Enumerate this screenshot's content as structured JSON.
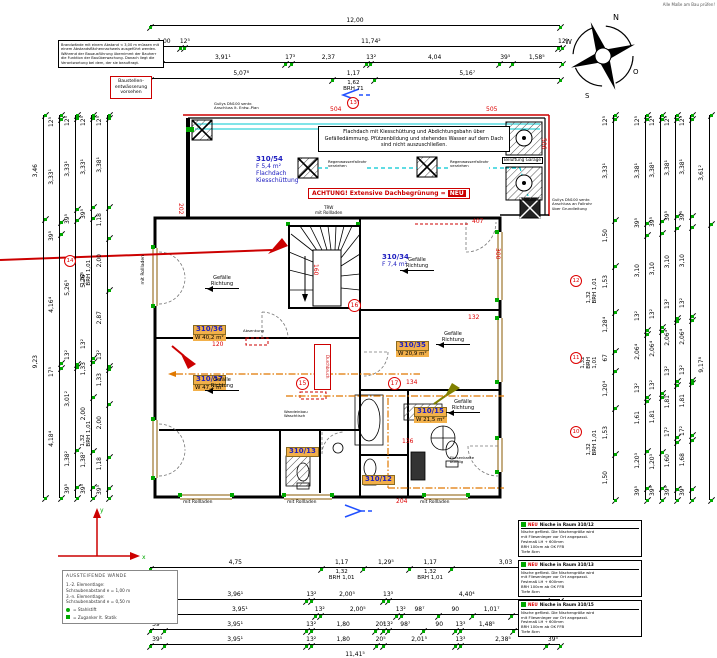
{
  "colors": {
    "tick_green": "#00a800",
    "position_red": "#dd0000",
    "room_highlight": "#f2b04a",
    "pipe_cyan": "#00c8d2",
    "label_blue": "#2020c0",
    "install_orange": "#e07800",
    "window_brown": "#8a5a00"
  },
  "corner_note": "Alle Maße am Bau prüfen!",
  "compass": {
    "n": "N",
    "o": "O",
    "s": "S",
    "w": "W"
  },
  "axes": {
    "x": "x",
    "y": "y"
  },
  "notes": {
    "general": "Brandwände mit einem Abstand < 3,00 m müssen mit einem Abstandsflächennachweis ausgeführt werden. Während der Bauausführung übernimmt der Bauherr die Funktion der Bauüberwachung. Danach liegt die Verantwortung bei dem, der sie beauftragt.",
    "drainage": "Baustellen- entwässerung vorsehen"
  },
  "roof": {
    "note": "Flachdach mit Kiesschüttung und Abdichtungsbahn über Gefälledämmung. Pfützenbildung und stehendes Wasser auf dem Dach sind nicht auszuschließen.",
    "warning_pre": "ACHTUNG! Extensive Dachbegrünung =",
    "warning_tag": "NEU",
    "trw": "TRW\nmit Rollladen",
    "garage_vent": "Belüftung Garage",
    "drain_left": "Gullys DN100 senkr.\nAnschluss lt. Entw.-Plan",
    "drain_mid1": "Regenwasserfallrohr\nverziehen",
    "drain_mid2": "Regenwasserfallrohr\nverziehen",
    "drain_right": "Gullys DN100 senkr.\nAnschluss an Fallrohr\nüber Grundleitung"
  },
  "plan": {
    "gefaelle_text": "Gefälle\nRichtung",
    "rooms": [
      {
        "id": "310/36",
        "area": "W 40,2 m²",
        "x": 193,
        "y": 316
      },
      {
        "id": "310/37",
        "area": "W 47,2 m²",
        "x": 193,
        "y": 366
      },
      {
        "id": "310/35",
        "area": "W 20,9 m²",
        "x": 396,
        "y": 332
      },
      {
        "id": "310/15",
        "area": "W 21,5 m²",
        "x": 414,
        "y": 398
      },
      {
        "id": "310/13",
        "area": "",
        "x": 286,
        "y": 438
      },
      {
        "id": "310/12",
        "area": "",
        "x": 362,
        "y": 466
      }
    ],
    "blue_labels": [
      {
        "id": "310/54",
        "lines": "F 5,4 m²\nFlachdach\nKiesschüttung",
        "x": 256,
        "y": 148
      },
      {
        "id": "310/34",
        "lines": "F 7,4 m²",
        "x": 382,
        "y": 246
      }
    ],
    "gefaelle": [
      {
        "x": 205,
        "y": 276
      },
      {
        "x": 205,
        "y": 378
      },
      {
        "x": 436,
        "y": 332
      },
      {
        "x": 400,
        "y": 258
      },
      {
        "x": 446,
        "y": 400
      }
    ],
    "red_tags": [
      {
        "t": "504",
        "x": 330,
        "y": 107
      },
      {
        "t": "505",
        "x": 486,
        "y": 107
      },
      {
        "t": "506",
        "x": 540,
        "y": 138,
        "vert": true
      },
      {
        "t": "202",
        "x": 177,
        "y": 203,
        "vert": true
      },
      {
        "t": "160",
        "x": 312,
        "y": 264,
        "vert": true
      },
      {
        "t": "120",
        "x": 212,
        "y": 342
      },
      {
        "t": "132",
        "x": 468,
        "y": 315
      },
      {
        "t": "134",
        "x": 406,
        "y": 380
      },
      {
        "t": "136",
        "x": 402,
        "y": 439
      },
      {
        "t": "300",
        "x": 494,
        "y": 248,
        "vert": true
      },
      {
        "t": "407",
        "x": 472,
        "y": 219
      },
      {
        "t": "204",
        "x": 396,
        "y": 499
      }
    ],
    "circles": [
      {
        "n": "16",
        "x": 348,
        "y": 299
      },
      {
        "n": "15",
        "x": 296,
        "y": 377
      },
      {
        "n": "17",
        "x": 388,
        "y": 377
      }
    ],
    "window_labels": [
      {
        "t": "mit Rollladen",
        "x": 142,
        "y": 255,
        "vert": true
      },
      {
        "t": "mit Rollladen",
        "x": 183,
        "y": 501
      },
      {
        "t": "mit Rollladen",
        "x": 287,
        "y": 501
      },
      {
        "t": "mit Rollladen",
        "x": 420,
        "y": 501
      }
    ],
    "micro": [
      {
        "t": "Absenkung",
        "x": 243,
        "y": 329
      },
      {
        "t": "Wandeinbau\nWaschtisch",
        "x": 284,
        "y": 410
      },
      {
        "t": "Fliesenkante\nbündig",
        "x": 450,
        "y": 456
      }
    ],
    "durchbruch": "Durchbruch"
  },
  "legend_left": {
    "title": "AUSSTEIFENDE WÄNDE",
    "lines": [
      "1.-2. Elementlage:",
      "Schraubenabstand e = 1,00 m",
      "3.-n. Elementlage:",
      "Schraubenabstand e = 0,50 m"
    ],
    "items": [
      {
        "t": "= Stahlstift"
      },
      {
        "t": "= Zuganker lt. Statik"
      }
    ]
  },
  "legend_right": {
    "boxes": [
      {
        "tag": "NEU",
        "title": "Nische in Raum 310/12",
        "lines": [
          "Nische gefliest. Die Nischengröße wird",
          "mit Fliesenleger vor Ort angepasst.",
          "Festmaß LH + 600mm",
          "BRH 100cm ab OK FFB",
          "Tiefe 8cm"
        ]
      },
      {
        "tag": "NEU",
        "title": "Nische in Raum 310/13",
        "lines": [
          "Nische gefliest. Die Nischengröße wird",
          "mit Fliesenleger vor Ort angepasst.",
          "Festmaß LH + 600mm",
          "BRH 100cm ab OK FFB",
          "Tiefe 8cm"
        ]
      },
      {
        "tag": "NEU",
        "title": "Nische in Raum 310/15",
        "lines": [
          "Nische gefliest. Die Nischengröße wird",
          "mit Fliesenleger vor Ort angepasst.",
          "Festmaß LH + 600mm",
          "BRH 100cm ab OK FFB",
          "Tiefe 8cm"
        ]
      }
    ]
  },
  "dims": [
    {
      "id": "t1",
      "dir": "h",
      "x": 150,
      "y": 12,
      "len": 410,
      "segs": [
        {
          "t": "12,00",
          "v": 12
        }
      ]
    },
    {
      "id": "t2",
      "dir": "h",
      "x": 148,
      "y": 33,
      "len": 414,
      "segs": [
        {
          "t": "1,00",
          "v": 1
        },
        {
          "t": "12⁵",
          "v": 0.125
        },
        {
          "t": "11,74²",
          "v": 11.742
        },
        {
          "t": "12⁵",
          "v": 0.125
        }
      ]
    },
    {
      "id": "t3",
      "dir": "h",
      "x": 148,
      "y": 49,
      "len": 414,
      "segs": [
        {
          "t": "39⁵",
          "v": 0.395
        },
        {
          "t": "3,91¹",
          "v": 3.911
        },
        {
          "t": "17³",
          "v": 0.173
        },
        {
          "t": "2,37",
          "v": 2.37
        },
        {
          "t": "13²",
          "v": 0.132
        },
        {
          "t": "4,04",
          "v": 4.04
        },
        {
          "t": "39⁵",
          "v": 0.395
        },
        {
          "t": "1,58⁵",
          "v": 1.585
        }
      ]
    },
    {
      "id": "t4",
      "dir": "h",
      "x": 150,
      "y": 65,
      "len": 410,
      "segs": [
        {
          "t": "5,07⁸",
          "v": 5.078
        },
        {
          "t": "1,17",
          "v": 1.17,
          "sub": "1,62\nBRH 71",
          "circ": "13"
        },
        {
          "t": "5,16⁷",
          "v": 5.167
        }
      ]
    },
    {
      "id": "b1",
      "dir": "h",
      "x": 150,
      "y": 554,
      "len": 410,
      "segs": [
        {
          "t": "4,75",
          "v": 4.75
        },
        {
          "t": "1,17",
          "v": 1.17,
          "sub": "1,32\nBRH 1,01"
        },
        {
          "t": "1,29⁵",
          "v": 1.295
        },
        {
          "t": "1,17",
          "v": 1.17,
          "sub": "1,32\nBRH 1,01"
        },
        {
          "t": "3,03",
          "v": 3.03
        }
      ]
    },
    {
      "id": "b2",
      "dir": "h",
      "x": 150,
      "y": 586,
      "len": 410,
      "segs": [
        {
          "t": "39⁵",
          "v": 0.395
        },
        {
          "t": "3,96¹",
          "v": 3.961
        },
        {
          "t": "13²",
          "v": 0.132
        },
        {
          "t": "2,00⁵",
          "v": 2.005
        },
        {
          "t": "13³",
          "v": 0.133
        },
        {
          "t": "4,40⁴",
          "v": 4.404
        },
        {
          "t": "39⁵",
          "v": 0.395
        }
      ]
    },
    {
      "id": "b3",
      "dir": "h",
      "x": 150,
      "y": 601,
      "len": 410,
      "segs": [
        {
          "t": "39⁵",
          "v": 0.395
        },
        {
          "t": "3,95¹",
          "v": 3.951
        },
        {
          "t": "13²",
          "v": 0.132
        },
        {
          "t": "2,00⁵",
          "v": 2.005
        },
        {
          "t": "13²",
          "v": 0.132
        },
        {
          "t": "98⁷",
          "v": 0.987
        },
        {
          "t": "90",
          "v": 0.9
        },
        {
          "t": "1,01⁷",
          "v": 1.017
        },
        {
          "t": "90",
          "v": 0.9
        },
        {
          "t": "39⁵",
          "v": 0.395
        }
      ]
    },
    {
      "id": "b4",
      "dir": "h",
      "x": 150,
      "y": 616,
      "len": 410,
      "segs": [
        {
          "t": "39⁵",
          "v": 0.395
        },
        {
          "t": "3,95¹",
          "v": 3.951
        },
        {
          "t": "13²",
          "v": 0.132
        },
        {
          "t": "1,80",
          "v": 1.8
        },
        {
          "t": "20⁵",
          "v": 0.205
        },
        {
          "t": "13²",
          "v": 0.132
        },
        {
          "t": "98⁷",
          "v": 0.987
        },
        {
          "t": "90",
          "v": 0.9
        },
        {
          "t": "13³",
          "v": 0.133
        },
        {
          "t": "1,48⁵",
          "v": 1.485
        },
        {
          "t": "90",
          "v": 0.9
        },
        {
          "t": "39⁵",
          "v": 0.395
        }
      ]
    },
    {
      "id": "b5",
      "dir": "h",
      "x": 150,
      "y": 631,
      "len": 410,
      "segs": [
        {
          "t": "39⁵",
          "v": 0.395
        },
        {
          "t": "3,95¹",
          "v": 3.951
        },
        {
          "t": "13²",
          "v": 0.132
        },
        {
          "t": "1,80",
          "v": 1.8
        },
        {
          "t": "20⁵",
          "v": 0.205
        },
        {
          "t": "2,01⁵",
          "v": 2.015
        },
        {
          "t": "13³",
          "v": 0.133
        },
        {
          "t": "2,38⁵",
          "v": 2.385
        },
        {
          "t": "39⁵",
          "v": 0.395
        }
      ]
    },
    {
      "id": "b6",
      "dir": "h",
      "x": 150,
      "y": 646,
      "len": 410,
      "segs": [
        {
          "t": "11,41⁵",
          "v": 11.415
        }
      ]
    },
    {
      "id": "l1",
      "dir": "v",
      "x": 30,
      "y": 115,
      "len": 383,
      "segs": [
        {
          "t": "3,46",
          "v": 3.46
        },
        {
          "t": "9,23",
          "v": 9.23
        }
      ]
    },
    {
      "id": "l2",
      "dir": "v",
      "x": 46,
      "y": 115,
      "len": 383,
      "segs": [
        {
          "t": "12⁵",
          "v": 0.125
        },
        {
          "t": "3,33¹",
          "v": 3.331
        },
        {
          "t": "39⁵",
          "v": 0.395
        },
        {
          "t": "4,16⁴",
          "v": 4.164
        },
        {
          "t": "17⁵",
          "v": 0.175
        },
        {
          "t": "4,18⁴",
          "v": 4.184
        }
      ]
    },
    {
      "id": "l3",
      "dir": "v",
      "x": 62,
      "y": 115,
      "len": 383,
      "segs": [
        {
          "t": "12⁵",
          "v": 0.125
        },
        {
          "t": "3,33¹",
          "v": 3.331
        },
        {
          "t": "39⁵",
          "v": 0.395
        },
        {
          "t": "5,26⁵",
          "v": 5.265
        },
        {
          "t": "13²",
          "v": 0.132
        },
        {
          "t": "3,01²",
          "v": 3.012
        },
        {
          "t": "1,38²",
          "v": 1.382
        },
        {
          "t": "39⁵",
          "v": 0.395
        }
      ]
    },
    {
      "id": "l4",
      "dir": "v",
      "x": 78,
      "y": 115,
      "len": 383,
      "segs": [
        {
          "t": "12⁵",
          "v": 0.125
        },
        {
          "t": "3,33¹",
          "v": 3.331
        },
        {
          "t": "39⁵",
          "v": 0.395
        },
        {
          "t": "5,26⁵",
          "v": 5.265
        },
        {
          "t": "13²",
          "v": 0.132
        },
        {
          "t": "1,33",
          "v": 1.33
        },
        {
          "t": "2,00",
          "v": 2.0
        },
        {
          "t": "1,38²",
          "v": 1.382
        },
        {
          "t": "39⁵",
          "v": 0.395
        }
      ]
    },
    {
      "id": "l5",
      "dir": "v",
      "x": 94,
      "y": 115,
      "len": 383,
      "segs": [
        {
          "t": "12⁵",
          "v": 0.125
        },
        {
          "t": "3,38¹",
          "v": 3.381
        },
        {
          "t": "1,18",
          "v": 1.18
        },
        {
          "t": "2,00",
          "v": 2.0,
          "sub": "1,32\nBRH 1,01",
          "circ": "14"
        },
        {
          "t": "2,87",
          "v": 2.87
        },
        {
          "t": "13²",
          "v": 0.132
        },
        {
          "t": "1,33",
          "v": 1.33
        },
        {
          "t": "2,00",
          "v": 2.0,
          "sub": "1,32\nBRH 1,01"
        },
        {
          "t": "1,18",
          "v": 1.18
        },
        {
          "t": "39⁵",
          "v": 0.395
        }
      ]
    },
    {
      "id": "r1",
      "dir": "v",
      "x": 600,
      "y": 115,
      "len": 385,
      "segs": [
        {
          "t": "12⁵",
          "v": 0.125
        },
        {
          "t": "3,33¹",
          "v": 3.331
        },
        {
          "t": "1,50",
          "v": 1.5
        },
        {
          "t": "1,53",
          "v": 1.53,
          "sub": "1,32\nBRH 1,01",
          "circ": "12"
        },
        {
          "t": "1,28⁴",
          "v": 1.284
        },
        {
          "t": "67",
          "v": 0.67,
          "sub": "1,32\nBRH 1,01",
          "circ": "11"
        },
        {
          "t": "1,20⁴",
          "v": 1.204
        },
        {
          "t": "1,53",
          "v": 1.53,
          "sub": "1,32\nBRH 1,01",
          "circ": "10"
        },
        {
          "t": "1,50",
          "v": 1.5
        }
      ]
    },
    {
      "id": "r2",
      "dir": "v",
      "x": 632,
      "y": 115,
      "len": 385,
      "segs": [
        {
          "t": "12⁵",
          "v": 0.125
        },
        {
          "t": "3,38¹",
          "v": 3.381
        },
        {
          "t": "39⁵",
          "v": 0.395
        },
        {
          "t": "3,10",
          "v": 3.1
        },
        {
          "t": "13²",
          "v": 0.132
        },
        {
          "t": "2,06⁴",
          "v": 2.064
        },
        {
          "t": "13²",
          "v": 0.132
        },
        {
          "t": "1,61",
          "v": 1.61
        },
        {
          "t": "1,20³",
          "v": 1.203
        },
        {
          "t": "39⁵",
          "v": 0.395
        }
      ]
    },
    {
      "id": "r3",
      "dir": "v",
      "x": 647,
      "y": 115,
      "len": 385,
      "segs": [
        {
          "t": "12⁵",
          "v": 0.125
        },
        {
          "t": "3,38¹",
          "v": 3.381
        },
        {
          "t": "39⁵",
          "v": 0.395
        },
        {
          "t": "3,10",
          "v": 3.1
        },
        {
          "t": "13²",
          "v": 0.132
        },
        {
          "t": "2,06⁴",
          "v": 2.064
        },
        {
          "t": "13²",
          "v": 0.132
        },
        {
          "t": "1,81",
          "v": 1.81
        },
        {
          "t": "1,20³",
          "v": 1.203
        },
        {
          "t": "39⁵",
          "v": 0.395
        }
      ]
    },
    {
      "id": "r4",
      "dir": "v",
      "x": 662,
      "y": 115,
      "len": 385,
      "segs": [
        {
          "t": "12⁵",
          "v": 0.125
        },
        {
          "t": "3,38¹",
          "v": 3.381
        },
        {
          "t": "39⁵",
          "v": 0.395
        },
        {
          "t": "3,10",
          "v": 3.1
        },
        {
          "t": "13²",
          "v": 0.132
        },
        {
          "t": "2,06⁴",
          "v": 2.064
        },
        {
          "t": "13²",
          "v": 0.132
        },
        {
          "t": "1,81",
          "v": 1.81
        },
        {
          "t": "17²",
          "v": 0.172
        },
        {
          "t": "1,60",
          "v": 1.6
        },
        {
          "t": "39⁵",
          "v": 0.395
        }
      ]
    },
    {
      "id": "r5",
      "dir": "v",
      "x": 677,
      "y": 115,
      "len": 385,
      "segs": [
        {
          "t": "12⁵",
          "v": 0.125
        },
        {
          "t": "3,38¹",
          "v": 3.381
        },
        {
          "t": "39⁵",
          "v": 0.395
        },
        {
          "t": "3,10",
          "v": 3.1
        },
        {
          "t": "13²",
          "v": 0.132
        },
        {
          "t": "2,06⁴",
          "v": 2.064
        },
        {
          "t": "13²",
          "v": 0.132
        },
        {
          "t": "1,81",
          "v": 1.81
        },
        {
          "t": "17²",
          "v": 0.172
        },
        {
          "t": "1,68",
          "v": 1.68
        },
        {
          "t": "39⁵",
          "v": 0.395
        }
      ]
    },
    {
      "id": "r6",
      "dir": "v",
      "x": 696,
      "y": 115,
      "len": 385,
      "segs": [
        {
          "t": "3,61²",
          "v": 3.612
        },
        {
          "t": "9,17⁸",
          "v": 9.178
        }
      ]
    }
  ]
}
